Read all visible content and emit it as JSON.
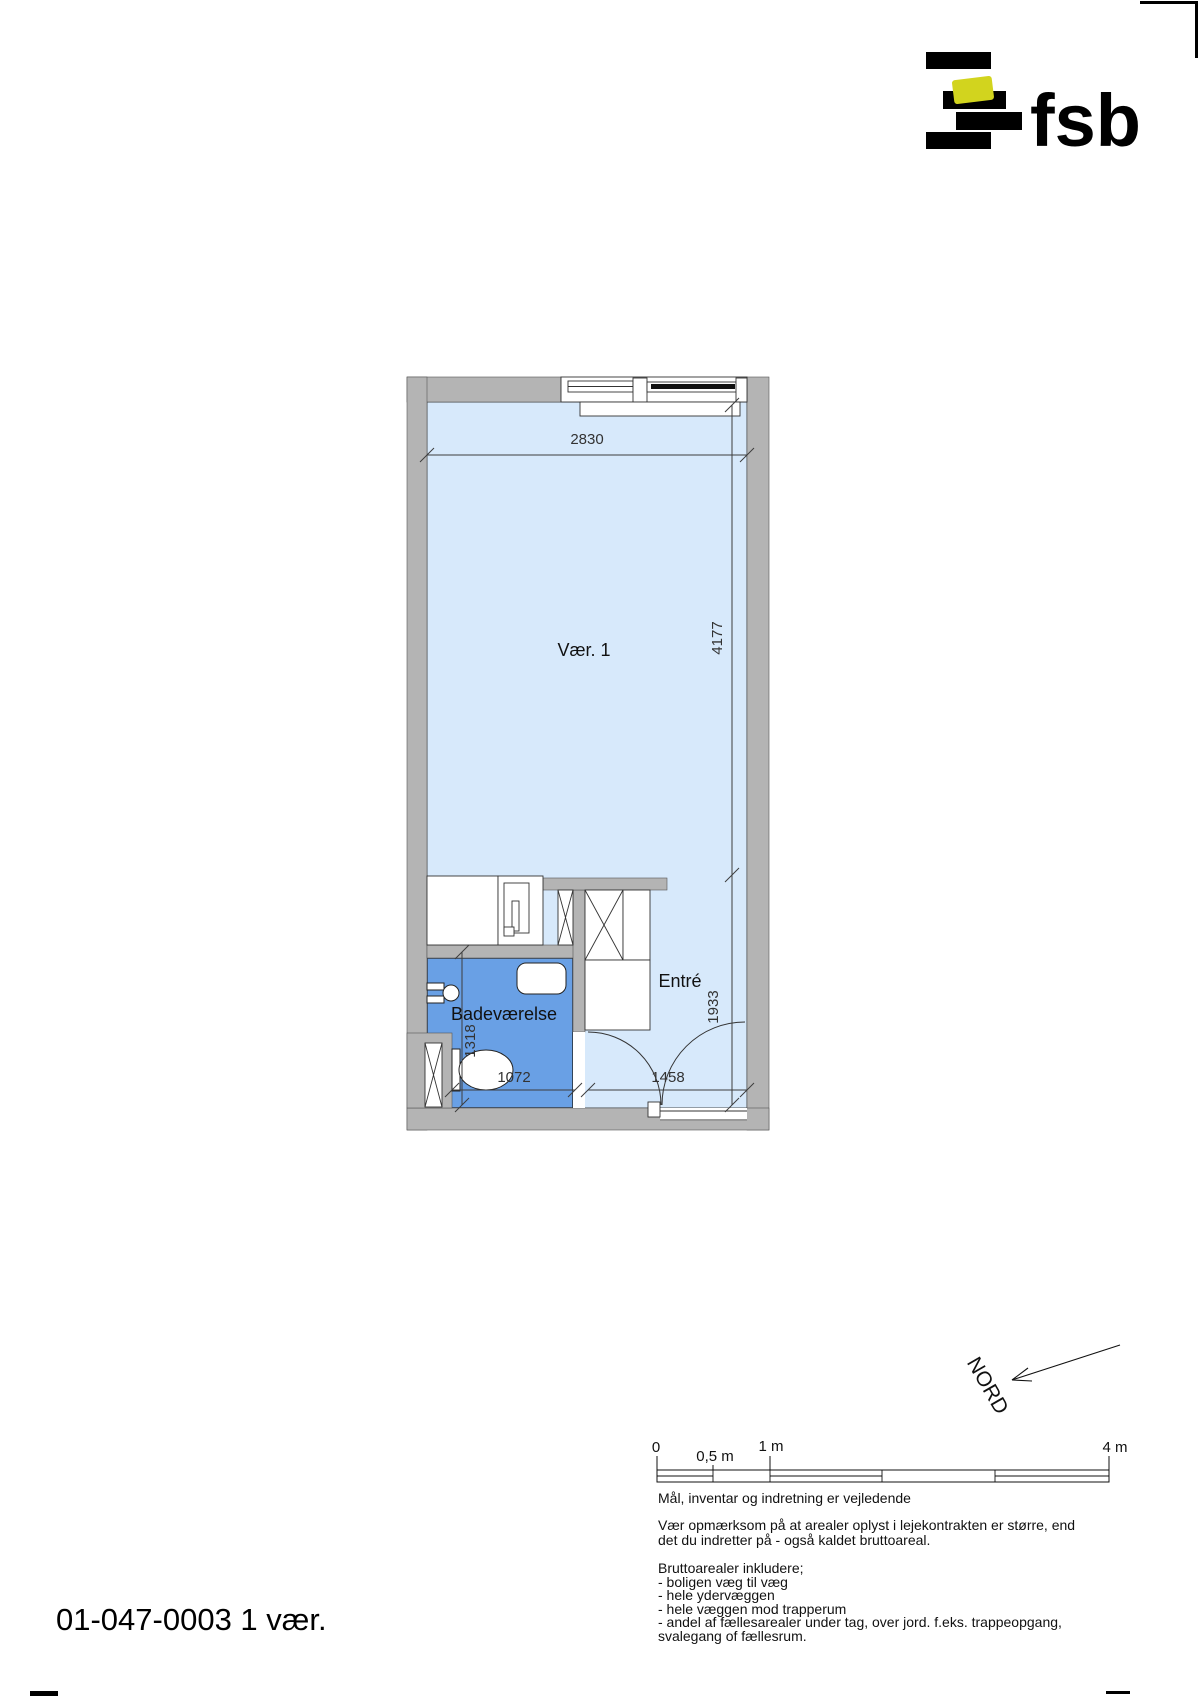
{
  "logo": {
    "text": "fsb"
  },
  "plan": {
    "room1_label": "Vær. 1",
    "bath_label": "Badeværelse",
    "entre_label": "Entré",
    "dim_top": "2830",
    "dim_right_main": "4177",
    "dim_right_entre": "1933",
    "dim_bath_vert": "1318",
    "dim_bath_horiz": "1072",
    "dim_entre_horiz": "1458",
    "colors": {
      "wall": "#b4b4b4",
      "room": "#d7e9fb",
      "bathroom": "#69a0e5",
      "logo_yellow": "#d2d41e"
    }
  },
  "compass": {
    "label": "NORD"
  },
  "scalebar": {
    "zero": "0",
    "half": "0,5 m",
    "one": "1 m",
    "four": "4 m"
  },
  "notes": {
    "guideline": "Mål, inventar og indretning er vejledende",
    "areas": "Vær opmærksom på at arealer oplyst i lejekontrakten er større, end\ndet du indretter på - også kaldet bruttoareal.",
    "brutto_title": "Bruttoarealer inkludere;",
    "brutto_list": "- boligen væg til væg\n- hele ydervæggen\n- hele væggen mod trapperum\n- andel af fællesarealer under tag, over jord. f.eks. trappeopgang,\nsvalegang of fællesrum."
  },
  "footer": {
    "plan_id": "01-047-0003 1 vær."
  }
}
